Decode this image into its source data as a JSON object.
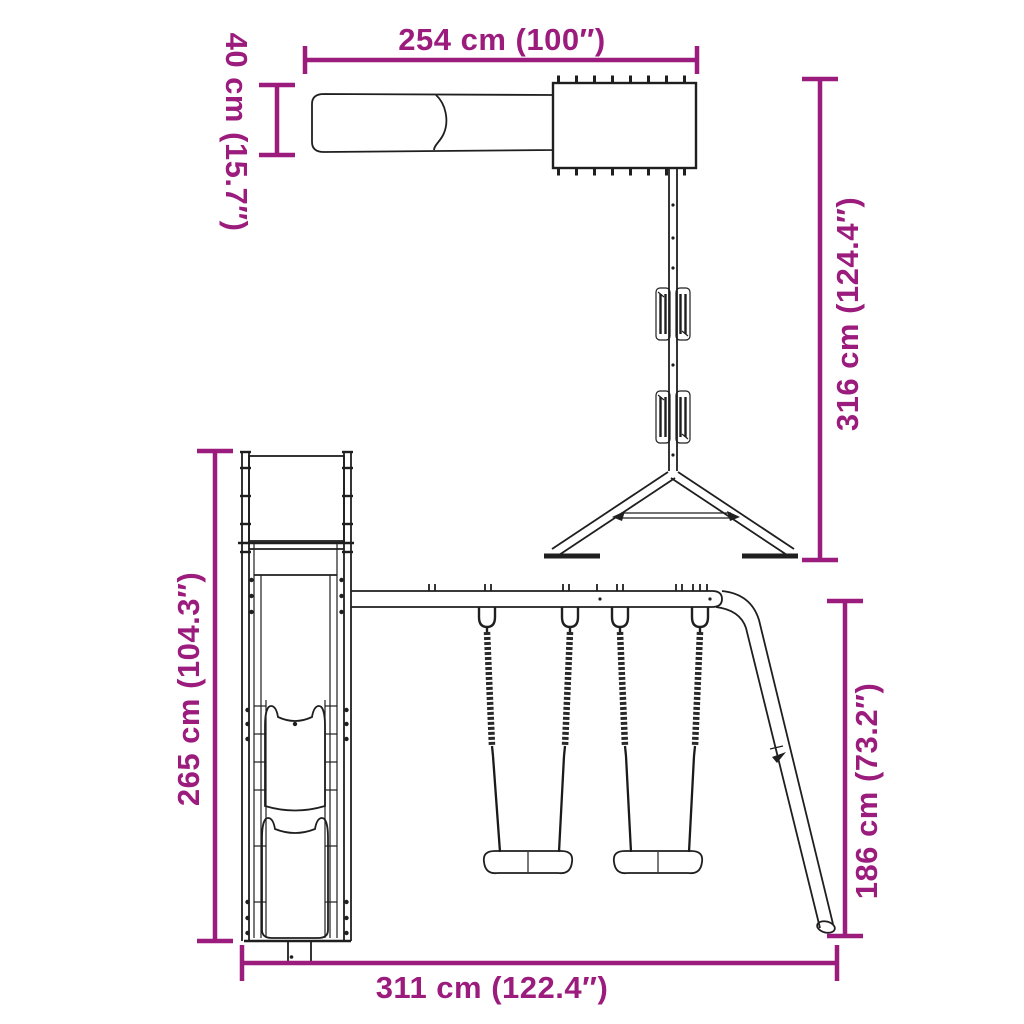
{
  "colors": {
    "accent": "#9B1C7D",
    "line": "#1f1f1f",
    "background": "#ffffff"
  },
  "diagram": {
    "type": "product-dimension-diagram",
    "subject": "wooden playset with slide, tower and double swing set (top view and side view)",
    "views": {
      "top_view": {
        "width_label": "254 cm (100″)",
        "slide_width_label": "40 cm (15.7″)",
        "depth_label": "316 cm (124.4″)"
      },
      "side_view": {
        "height_label": "265 cm (104.3″)",
        "swing_height_label": "186 cm (73.2″)",
        "length_label": "311 cm (122.4″)"
      }
    }
  }
}
